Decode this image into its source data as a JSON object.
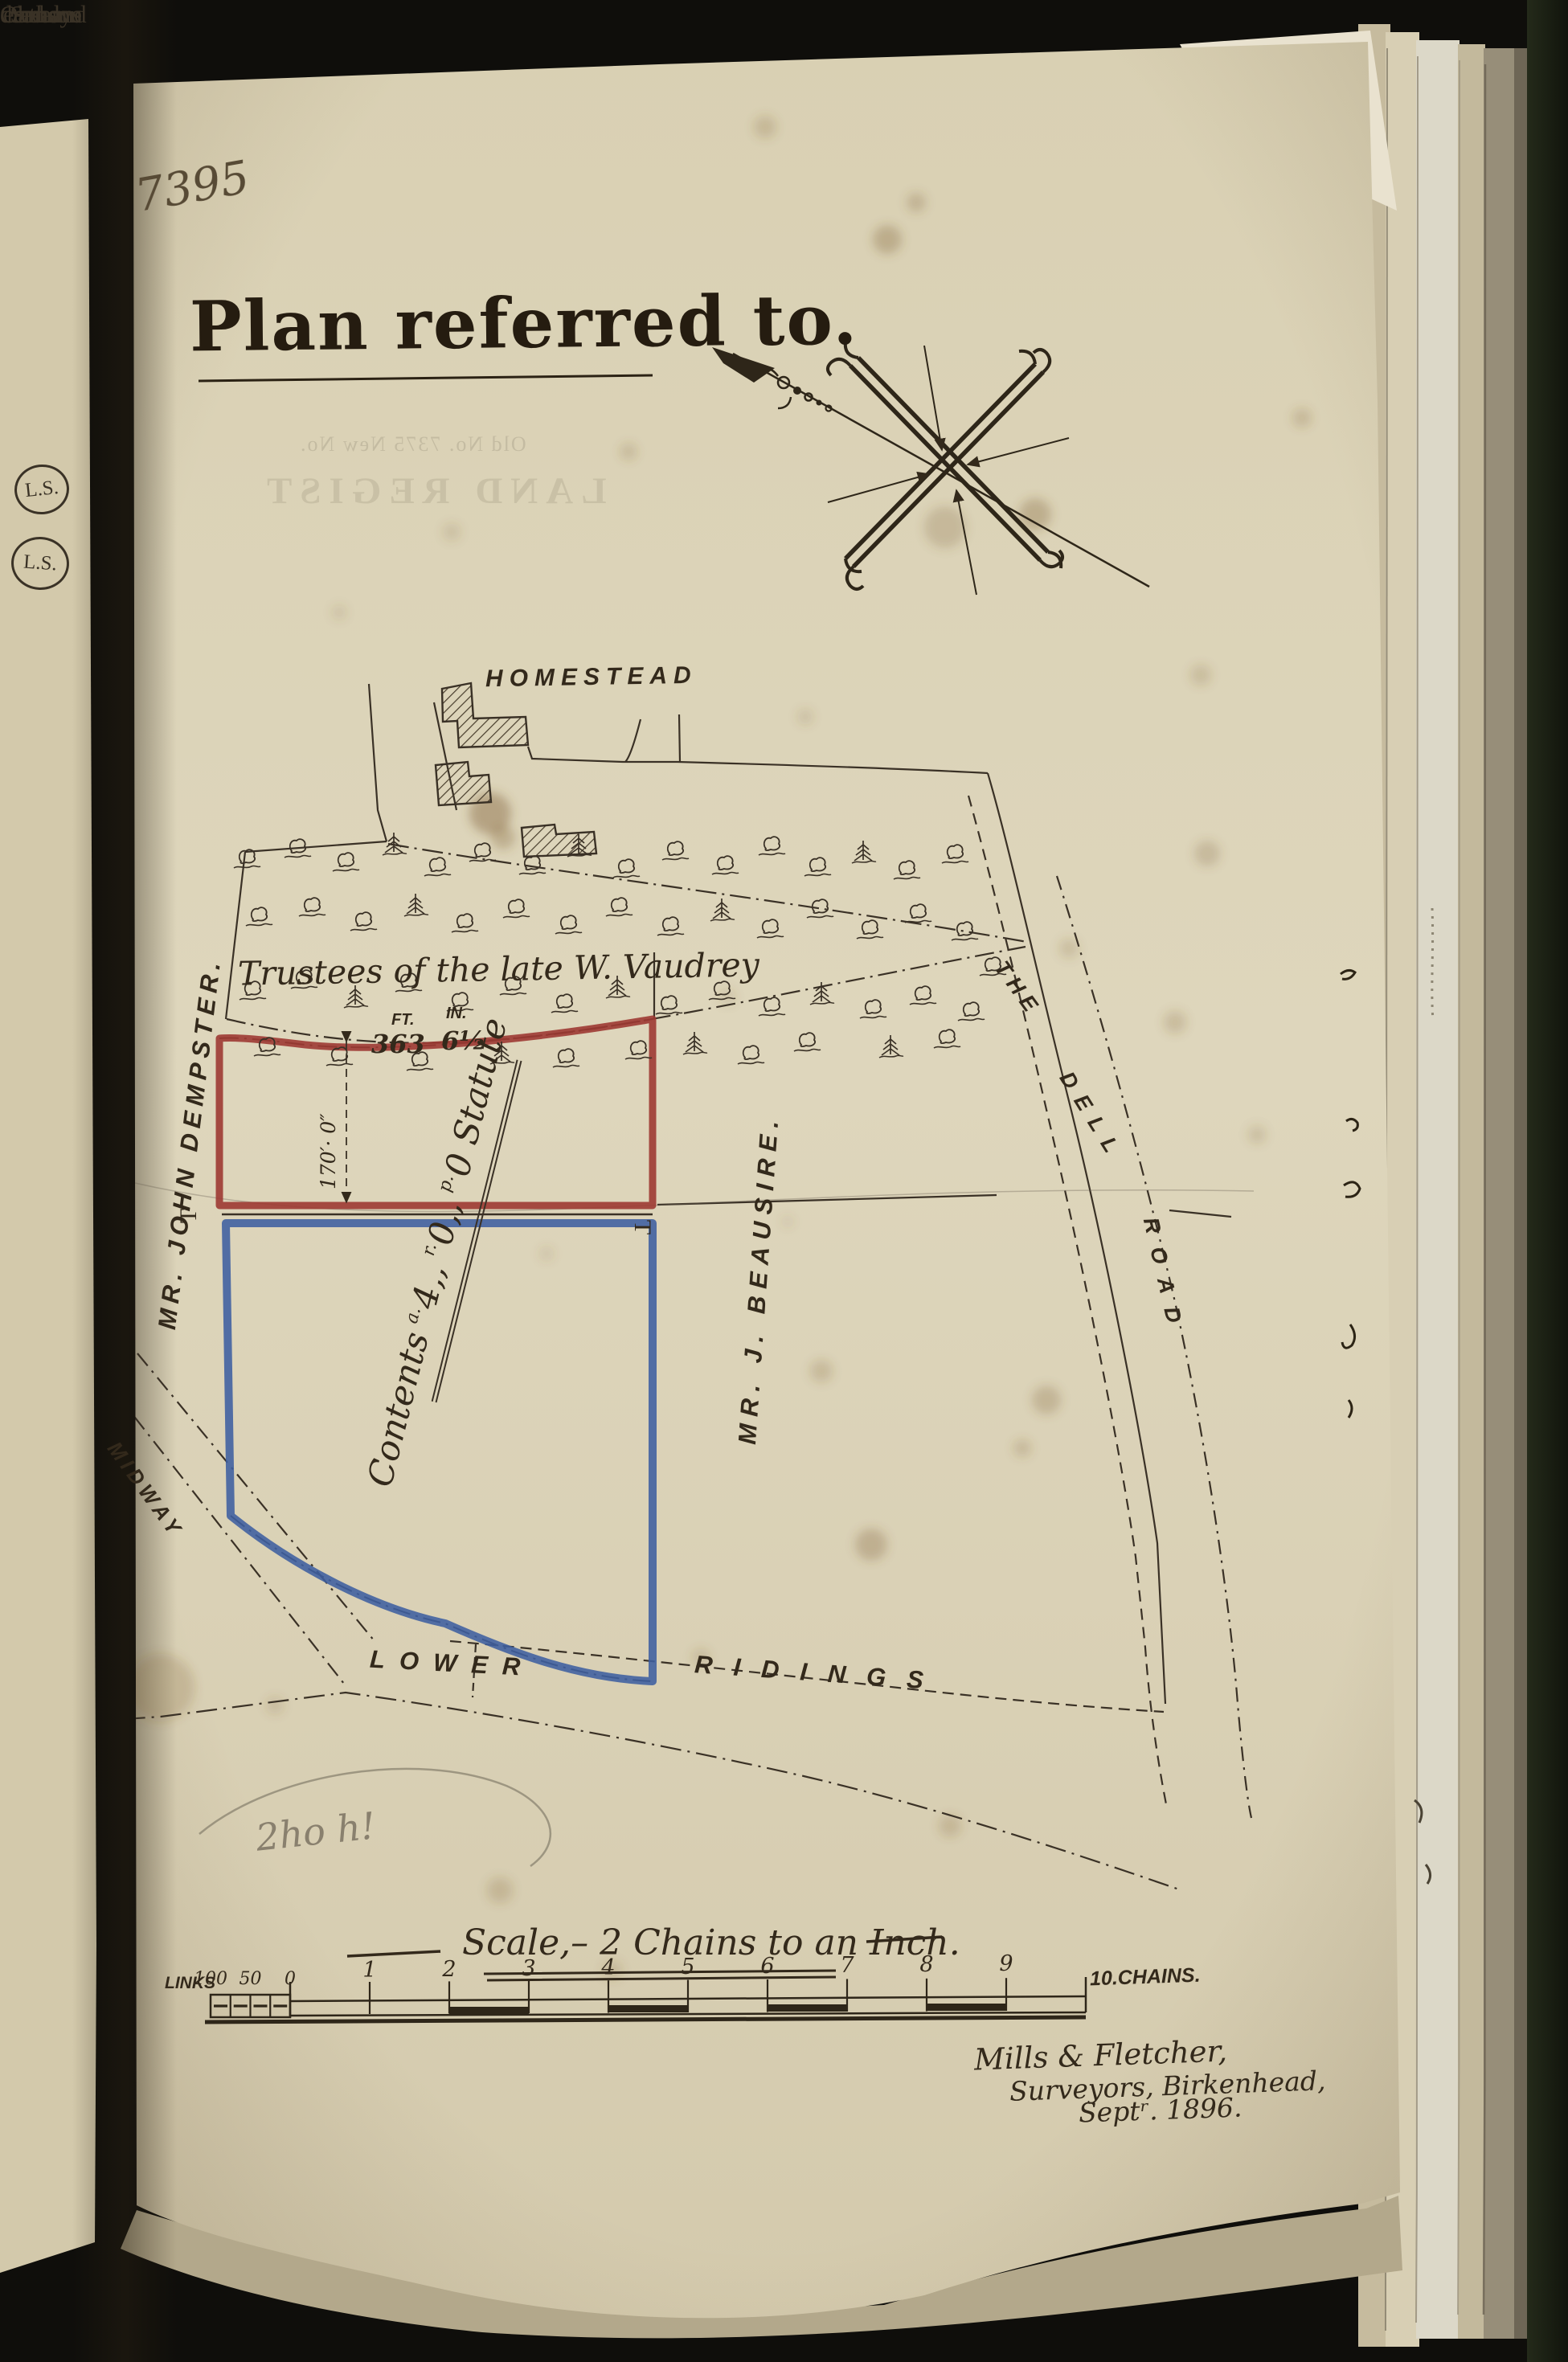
{
  "annotations": {
    "folio_number": "7395",
    "pencil_note": "2ho h!"
  },
  "title": "Plan referred to.",
  "map": {
    "homestead_label": "HOMESTEAD",
    "trustees_label": "Trustees of the late W. Vaudrey",
    "owner_left": "MR. JOHN DEMPSTER.",
    "owner_right": "MR. J. BEAUSIRE.",
    "road_midway": "MIDWAY",
    "road_dell": [
      "THE",
      "DELL",
      "ROAD"
    ],
    "road_lower": [
      "LOWER",
      "RIDINGS"
    ],
    "contents": {
      "word": "Contents",
      "a_sup": "a.",
      "a": "4,,",
      "r_sup": "r.",
      "r": "0,,",
      "p_sup": "p.",
      "p": "0",
      "suffix": "Statute"
    },
    "height_dim": "170′· 0″",
    "measure": {
      "ft_label": "FT.",
      "ft_value": "363",
      "in_label": "IN.",
      "in_value": "6½"
    },
    "t_marks": [
      "T",
      "T"
    ],
    "trees": [
      [
        305,
        1068,
        "d"
      ],
      [
        368,
        1055,
        "d"
      ],
      [
        428,
        1072,
        "d"
      ],
      [
        488,
        1050,
        "c"
      ],
      [
        542,
        1078,
        "d"
      ],
      [
        598,
        1060,
        "d"
      ],
      [
        660,
        1076,
        "d"
      ],
      [
        718,
        1052,
        "c"
      ],
      [
        777,
        1080,
        "d"
      ],
      [
        838,
        1058,
        "d"
      ],
      [
        900,
        1076,
        "d"
      ],
      [
        958,
        1052,
        "d"
      ],
      [
        1015,
        1078,
        "d"
      ],
      [
        1072,
        1060,
        "c"
      ],
      [
        1126,
        1082,
        "d"
      ],
      [
        1186,
        1062,
        "d"
      ],
      [
        320,
        1140,
        "d"
      ],
      [
        386,
        1128,
        "d"
      ],
      [
        450,
        1146,
        "d"
      ],
      [
        515,
        1126,
        "c"
      ],
      [
        576,
        1148,
        "d"
      ],
      [
        640,
        1130,
        "d"
      ],
      [
        705,
        1150,
        "d"
      ],
      [
        768,
        1128,
        "d"
      ],
      [
        832,
        1152,
        "d"
      ],
      [
        896,
        1132,
        "c"
      ],
      [
        956,
        1155,
        "d"
      ],
      [
        1018,
        1130,
        "d"
      ],
      [
        1080,
        1156,
        "d"
      ],
      [
        1140,
        1136,
        "d"
      ],
      [
        1198,
        1158,
        "d"
      ],
      [
        312,
        1232,
        "d"
      ],
      [
        376,
        1218,
        "d"
      ],
      [
        440,
        1240,
        "c"
      ],
      [
        506,
        1222,
        "d"
      ],
      [
        570,
        1246,
        "d"
      ],
      [
        636,
        1226,
        "d"
      ],
      [
        700,
        1248,
        "d"
      ],
      [
        766,
        1228,
        "c"
      ],
      [
        830,
        1250,
        "d"
      ],
      [
        896,
        1232,
        "d"
      ],
      [
        958,
        1252,
        "d"
      ],
      [
        1020,
        1236,
        "c"
      ],
      [
        1084,
        1255,
        "d"
      ],
      [
        1146,
        1238,
        "d"
      ],
      [
        1206,
        1258,
        "d"
      ],
      [
        330,
        1302,
        "d"
      ],
      [
        420,
        1314,
        "d"
      ],
      [
        520,
        1320,
        "d"
      ],
      [
        622,
        1310,
        "c"
      ],
      [
        702,
        1316,
        "d"
      ],
      [
        792,
        1306,
        "d"
      ],
      [
        862,
        1298,
        "c"
      ],
      [
        932,
        1312,
        "d"
      ],
      [
        1002,
        1296,
        "d"
      ],
      [
        1106,
        1302,
        "c"
      ],
      [
        1176,
        1292,
        "d"
      ],
      [
        1233,
        1202,
        "d"
      ]
    ]
  },
  "scale": {
    "caption": "Scale,– 2 Chains to an Inch.",
    "links_label": "LINKS",
    "links_ticks": [
      "100",
      "50",
      "0"
    ],
    "chain_ticks": [
      "1",
      "2",
      "3",
      "4",
      "5",
      "6",
      "7",
      "8",
      "9"
    ],
    "end_label": "10.CHAINS."
  },
  "surveyor": {
    "line1": "Mills & Fletcher,",
    "line2": "Surveyors, Birkenhead,",
    "line3": "Septʳ. 1896."
  },
  "left_page": {
    "fragments": [
      "h non-",
      "e same",
      "Sandys",
      "e me on",
      "dred and",
      "Oaths."
    ],
    "seals": [
      "L.S.",
      "L.S."
    ]
  },
  "show_through": {
    "line1": "Old No. 7375      New No.",
    "line2": "LAND REGIST"
  },
  "colors": {
    "parcel_red": "#9d3a33",
    "parcel_blue": "#3e5fa0",
    "ink": "#33291b",
    "paper": "#dcd3b7"
  }
}
